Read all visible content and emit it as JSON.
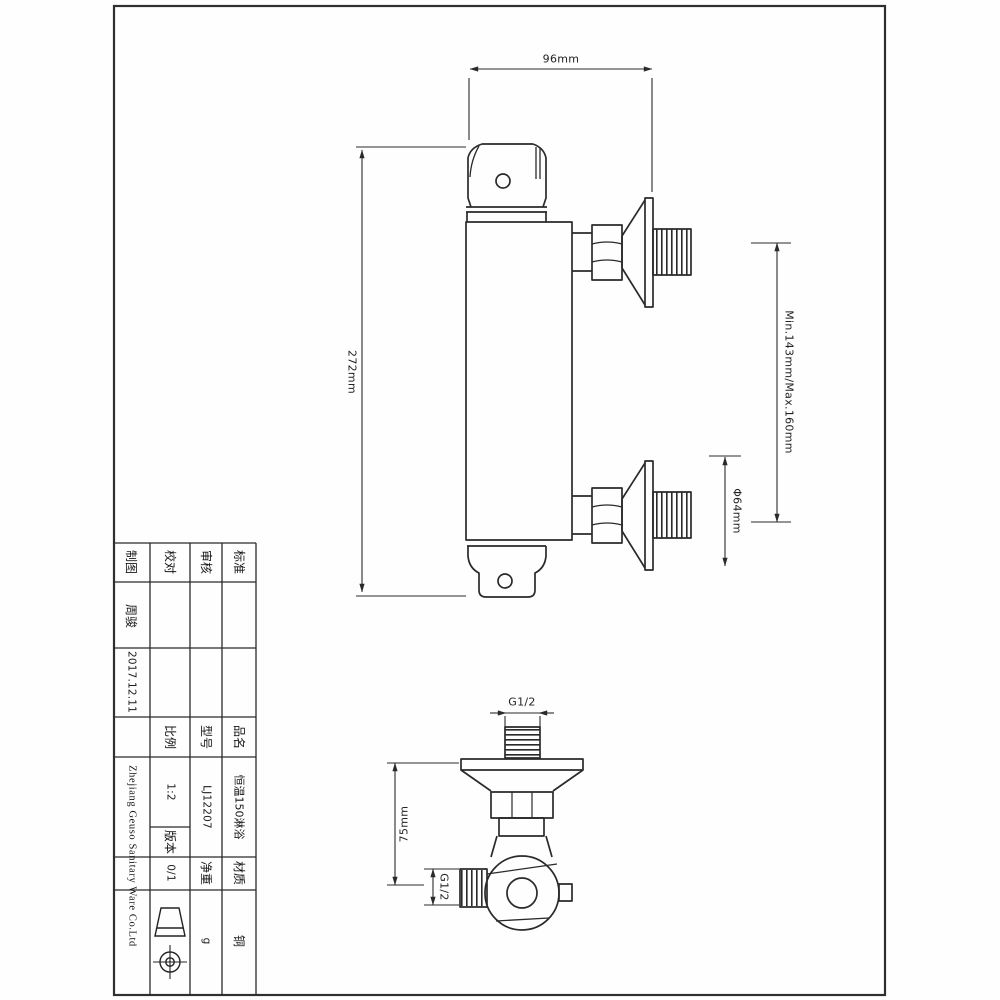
{
  "sheet": {
    "front_view": {
      "dim_width": "96mm",
      "dim_height": "272mm",
      "dim_pipe_spacing": "Min.143mm/Max.160mm",
      "dim_flange_diameter": "Φ64mm"
    },
    "side_view": {
      "dim_depth": "75mm",
      "top_thread": "G1/2",
      "side_thread": "G1/2"
    },
    "title_block": {
      "drafted_label": "制图",
      "checked_label": "校对",
      "audited_label": "审核",
      "standard_label": "标准",
      "drafter_name": "周骏",
      "date": "2017.12.11",
      "company": "Zhejiang Geuso Sanitary Ware Co.Ltd",
      "scale_label": "比例",
      "scale": "1:2",
      "version_label": "版本",
      "version": "0/1",
      "model_label": "型号",
      "model": "LJ12207",
      "weight_label": "净重",
      "weight_unit": "g",
      "product_label": "品名",
      "product_name": "恒温150淋浴",
      "material_label": "材质",
      "material": "铜",
      "projection_symbol": "first-angle-projection-icon"
    },
    "line_color": "#2a2a2a"
  }
}
